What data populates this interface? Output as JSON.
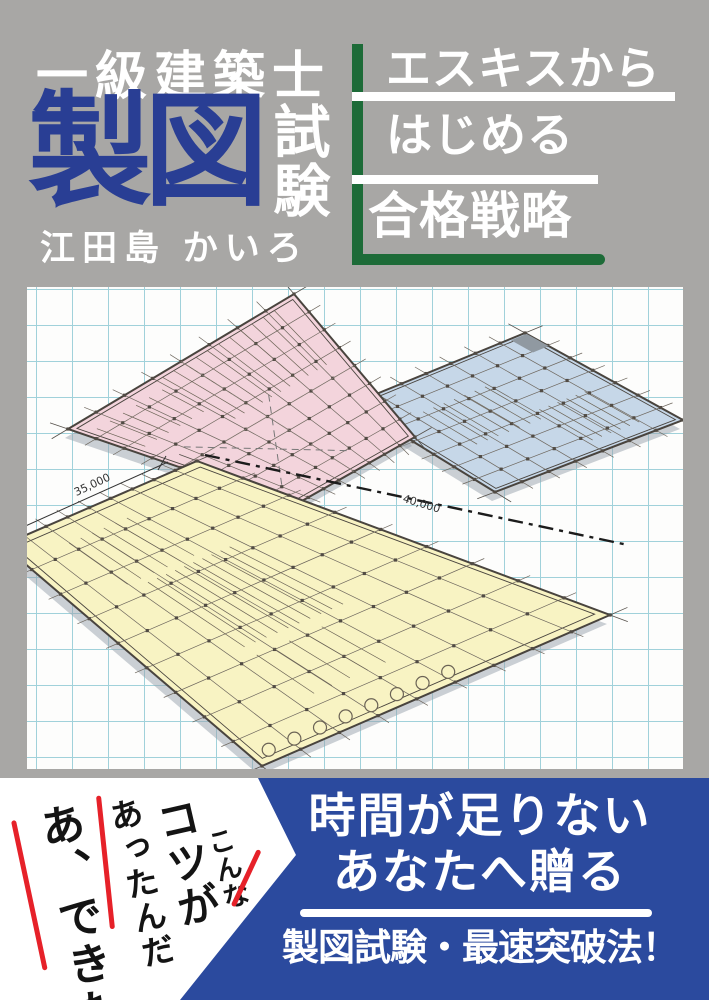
{
  "header": {
    "series_title": "一級建築士",
    "main_title": "製図",
    "main_title_suffix": "試験",
    "author": "江田島 かいろ",
    "tagline_lines": [
      "エスキスから",
      "はじめる",
      "合格戦略"
    ]
  },
  "artwork": {
    "dimension_labels": [
      "35,000",
      "40,000"
    ],
    "paper": {
      "grid_color": "#a0d1da",
      "background": "#fdfdfc"
    },
    "plans": [
      {
        "id": "blue-floor-plan",
        "fill": "#c6d7e8",
        "corners": [
          [
            525,
            333
          ],
          [
            683,
            420
          ],
          [
            495,
            492
          ],
          [
            352,
            404
          ]
        ],
        "divisions": 7,
        "core": true,
        "hatches": [
          [
            0.25,
            0.62,
            0.45,
            0.8,
            7
          ],
          [
            0.55,
            0.9,
            0.15,
            0.4,
            6
          ]
        ]
      },
      {
        "id": "pink-floor-plan",
        "fill": "#f3d4dc",
        "corners": [
          [
            294,
            294
          ],
          [
            415,
            437
          ],
          [
            293,
            506
          ],
          [
            68,
            429
          ]
        ],
        "divisions": 8,
        "cross": true,
        "hatches": [
          [
            0.02,
            0.42,
            0.1,
            0.6,
            11
          ],
          [
            0.08,
            0.3,
            0.65,
            0.95,
            6
          ]
        ]
      },
      {
        "id": "yellow-floor-plan",
        "fill": "#f8f3c3",
        "corners": [
          [
            197,
            461
          ],
          [
            610,
            615
          ],
          [
            262,
            766
          ],
          [
            3,
            545
          ]
        ],
        "divisions": 9,
        "circles": true,
        "hatches": [
          [
            0.3,
            0.62,
            0.38,
            0.72,
            10
          ],
          [
            0.08,
            0.28,
            0.5,
            0.78,
            6
          ],
          [
            0.66,
            0.85,
            0.5,
            0.72,
            5
          ]
        ]
      }
    ]
  },
  "footer": {
    "handwritten_lines": [
      "こんな",
      "コツが",
      "あったんだ",
      "あ、できた"
    ],
    "banner_lines": [
      "時間が足りない",
      "あなたへ贈る"
    ],
    "banner_bottom": "製図試験・最速突破法！"
  },
  "colors": {
    "background_gray": "#a8a7a5",
    "title_navy": "#293e94",
    "banner_blue": "#2b4a9e",
    "accent_green": "#1d6b38",
    "accent_red": "#e62129",
    "plan_pink": "#f3d4dc",
    "plan_blue": "#c6d7e8",
    "plan_yellow": "#f8f3c3"
  }
}
